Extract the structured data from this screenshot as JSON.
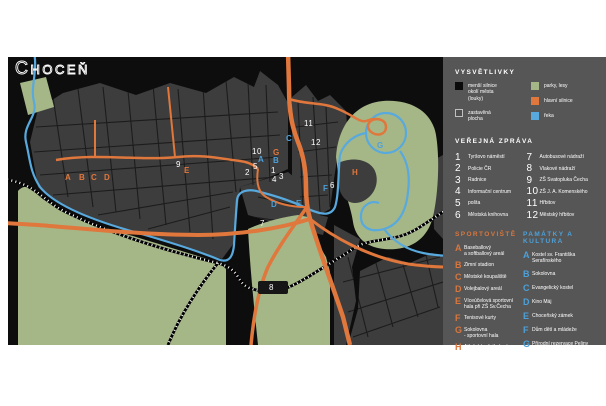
{
  "title": "Choceň",
  "colors": {
    "map_background": "#0d0d0d",
    "built_area": "#3d3d3d",
    "parks": "#a5b787",
    "main_road": "#e0773c",
    "river": "#58a9dd",
    "panel_background": "#565656",
    "sports_accent": "#d9763c",
    "culture_accent": "#4da0d8"
  },
  "panel": {
    "legend": {
      "heading": "VYSVĚTLIVKY",
      "items_left": [
        {
          "label": "menší silnice\nokolí města\n(louky)",
          "color": "#0a0a0a",
          "border": "#0a0a0a"
        },
        {
          "label": "zastavěná\nplocha",
          "color": "#4f4f4f",
          "border": "#c0c0c0"
        }
      ],
      "items_right": [
        {
          "label": "parky, lesy",
          "color": "#a5b787",
          "border": "#a5b787"
        },
        {
          "label": "hlavní silnice",
          "color": "#e0773c",
          "border": "#e0773c"
        },
        {
          "label": "řeka",
          "color": "#58a9dd",
          "border": "#58a9dd"
        }
      ]
    },
    "public": {
      "heading": "VEŘEJNÁ ZPRÁVA",
      "items": [
        {
          "num": "1",
          "label": "Tyršovo náměstí"
        },
        {
          "num": "2",
          "label": "Policie ČR"
        },
        {
          "num": "3",
          "label": "Radnice"
        },
        {
          "num": "4",
          "label": "Informační centrum"
        },
        {
          "num": "5",
          "label": "pošta"
        },
        {
          "num": "6",
          "label": "Městská knihovna"
        },
        {
          "num": "7",
          "label": "Autobusové nádraží"
        },
        {
          "num": "8",
          "label": "Vlakové nádraží"
        },
        {
          "num": "9",
          "label": "ZŠ Svatopluka Čecha"
        },
        {
          "num": "10",
          "label": "ZŠ J. A. Komenského"
        },
        {
          "num": "11",
          "label": "Hřbitov"
        },
        {
          "num": "12",
          "label": "Městský hřbitov"
        }
      ]
    },
    "sports": {
      "heading": "SPORTOVIŠTĚ",
      "items": [
        {
          "letter": "A",
          "label": "Baseballový\na softballový areál"
        },
        {
          "letter": "B",
          "label": "Zimní stadion"
        },
        {
          "letter": "C",
          "label": "Městské koupaliště"
        },
        {
          "letter": "D",
          "label": "Volejbalový areál"
        },
        {
          "letter": "E",
          "label": "Víceúčelová sportovní\nhala při ZŠ Sv.Čecha"
        },
        {
          "letter": "F",
          "label": "Tenisové kurty"
        },
        {
          "letter": "G",
          "label": "Sokolovna\n- sportovní hala"
        },
        {
          "letter": "H",
          "label": "Atletický a fotbalový\nstadion na Parapleti"
        }
      ]
    },
    "culture": {
      "heading": "PAMÁTKY A KULTURA",
      "items": [
        {
          "letter": "A",
          "label": "Kostel sv. Františka\nSerafínského"
        },
        {
          "letter": "B",
          "label": "Sokolovna"
        },
        {
          "letter": "C",
          "label": "Evangelický kostel"
        },
        {
          "letter": "D",
          "label": "Kino Máj"
        },
        {
          "letter": "E",
          "label": "Choceňský zámek"
        },
        {
          "letter": "F",
          "label": "Dům dětí a mládeže"
        },
        {
          "letter": "G",
          "label": "Přírodní rezervace Peliny"
        }
      ]
    }
  },
  "map": {
    "numbers": [
      {
        "n": "1",
        "x": 263,
        "y": 110
      },
      {
        "n": "2",
        "x": 237,
        "y": 112
      },
      {
        "n": "3",
        "x": 271,
        "y": 116
      },
      {
        "n": "4",
        "x": 264,
        "y": 119
      },
      {
        "n": "5",
        "x": 245,
        "y": 106
      },
      {
        "n": "6",
        "x": 322,
        "y": 125
      },
      {
        "n": "7",
        "x": 252,
        "y": 163
      },
      {
        "n": "8",
        "x": 261,
        "y": 227
      },
      {
        "n": "9",
        "x": 168,
        "y": 104
      },
      {
        "n": "10",
        "x": 244,
        "y": 91
      },
      {
        "n": "11",
        "x": 296,
        "y": 63
      },
      {
        "n": "12",
        "x": 303,
        "y": 82
      }
    ],
    "sport_markers": [
      {
        "l": "A",
        "x": 57,
        "y": 117
      },
      {
        "l": "B",
        "x": 71,
        "y": 117
      },
      {
        "l": "C",
        "x": 83,
        "y": 117
      },
      {
        "l": "D",
        "x": 96,
        "y": 117
      },
      {
        "l": "E",
        "x": 176,
        "y": 110
      },
      {
        "l": "G",
        "x": 265,
        "y": 92
      },
      {
        "l": "H",
        "x": 344,
        "y": 112
      }
    ],
    "culture_markers": [
      {
        "l": "A",
        "x": 250,
        "y": 99
      },
      {
        "l": "B",
        "x": 265,
        "y": 100
      },
      {
        "l": "C",
        "x": 278,
        "y": 78
      },
      {
        "l": "D",
        "x": 263,
        "y": 144
      },
      {
        "l": "E",
        "x": 288,
        "y": 143
      },
      {
        "l": "F",
        "x": 315,
        "y": 128
      },
      {
        "l": "G",
        "x": 369,
        "y": 85
      }
    ]
  }
}
